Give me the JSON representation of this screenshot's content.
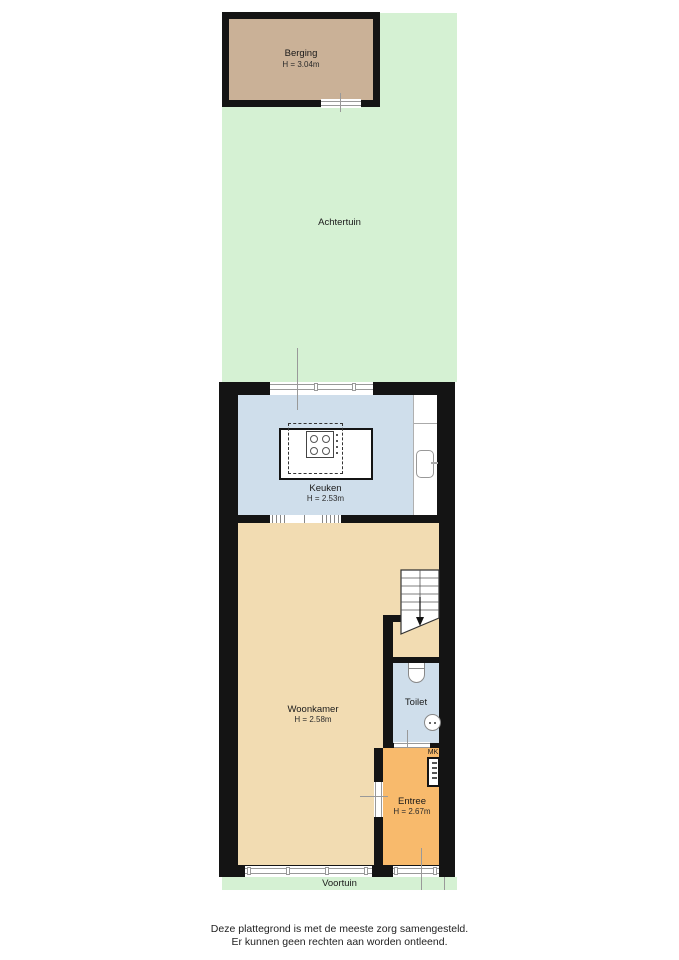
{
  "rooms": {
    "berging": {
      "name": "Berging",
      "height": "H = 3.04m"
    },
    "achtertuin": {
      "name": "Achtertuin"
    },
    "keuken": {
      "name": "Keuken",
      "height": "H = 2.53m"
    },
    "woonkamer": {
      "name": "Woonkamer",
      "height": "H = 2.58m"
    },
    "toilet": {
      "name": "Toilet"
    },
    "mk": {
      "label": "MK"
    },
    "entree": {
      "name": "Entree",
      "height": "H = 2.67m"
    },
    "voortuin": {
      "name": "Voortuin"
    }
  },
  "footer": {
    "line1": "Deze plattegrond is met de meeste zorg samengesteld.",
    "line2": "Er kunnen geen rechten aan worden ontleend."
  },
  "colors": {
    "garden": "#d5f1d3",
    "berging_floor": "#cab197",
    "kitchen_floor": "#cfdeeb",
    "livingroom_floor": "#f2dcb2",
    "entry_floor": "#f8ba6c",
    "wall": "#141414",
    "window_line": "#999999"
  }
}
